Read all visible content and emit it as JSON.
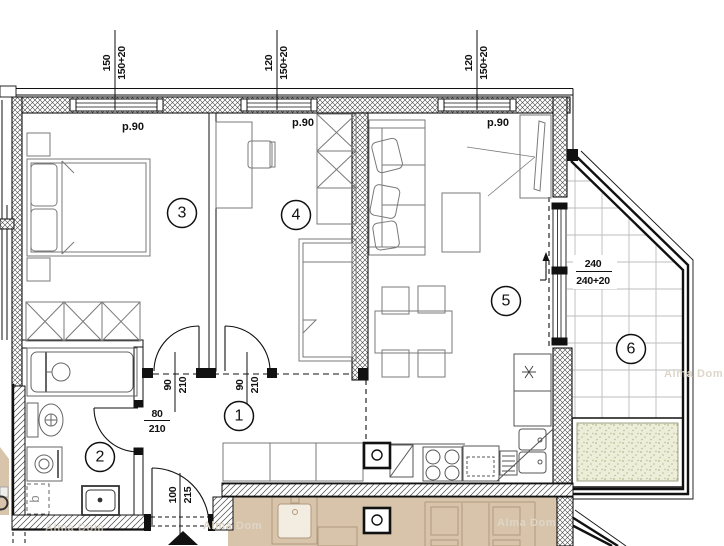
{
  "room_numbers": {
    "r1": "1",
    "r2": "2",
    "r3": "3",
    "r4": "4",
    "r5": "5",
    "r6": "6"
  },
  "labels": {
    "parapet": "p.90",
    "boiler": "b",
    "watermark": "Alma Dom"
  },
  "dims": {
    "win1_a": "150",
    "win1_b": "150+20",
    "win2_a": "120",
    "win2_b": "150+20",
    "win3_a": "120",
    "win3_b": "150+20",
    "balcony_a": "240",
    "balcony_b": "240+20",
    "door3_a": "90",
    "door3_b": "210",
    "door4_a": "90",
    "door4_b": "210",
    "bath_a": "80",
    "bath_b": "210",
    "entry_a": "100",
    "entry_b": "215"
  },
  "colors": {
    "wall_line": "#111111",
    "hatch_line": "#474747",
    "furniture_line": "#7a7a7a",
    "neighbor_floor": "#d7c4ab",
    "neighbor_line": "#b09a7e",
    "neighbor_fill": "#f3ece1",
    "planter_fill": "#eceeda",
    "planter_dot": "#b9ba8c",
    "tile_line": "#bcbcbc",
    "watermark": "#ded6c8"
  }
}
